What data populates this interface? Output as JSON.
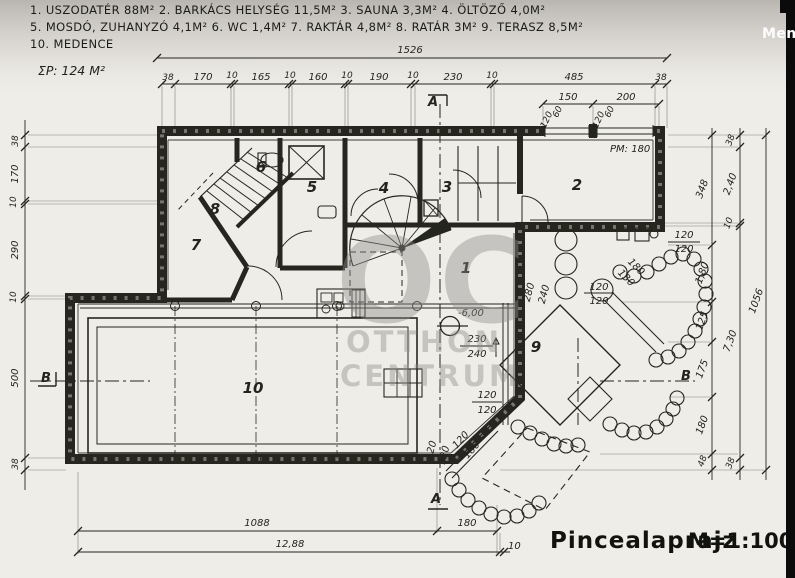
{
  "overlay": {
    "save_label": "Ment"
  },
  "legend": {
    "line1": "1. USZODATÉR 88M²   2. BARKÁCS HELYSÉG 11,5M²   3. SAUNA 3,3M²   4. ÖLTÖZŐ 4,0M²",
    "line2": "5. MOSDÓ, ZUHANYZÓ 4,1M²   6. WC 1,4M²   7. RAKTÁR 4,8M²   8. RATÁR 3M²   9. TERASZ 8,5M²",
    "line3": "10. MEDENCE"
  },
  "summary": {
    "total_area": "ΣP: 124 M²"
  },
  "title": {
    "name": "Pincealaprajz",
    "scale": "M=1:100"
  },
  "watermark": {
    "monogram": "OC",
    "line1": "OTTHON",
    "line2": "CENTRUM"
  },
  "rooms": {
    "n1": "1",
    "n2": "2",
    "n3": "3",
    "n4": "4",
    "n5": "5",
    "n6": "6",
    "n7": "7",
    "n8": "8",
    "n9": "9",
    "n10": "10"
  },
  "annotations": {
    "level": "-6,00",
    "ceiling": "PM: 180"
  },
  "sections": {
    "a": "A",
    "b": "B"
  },
  "dims": {
    "top_total": "1526",
    "top_chain": [
      "38",
      "170",
      "10",
      "165",
      "10",
      "160",
      "10",
      "190",
      "10",
      "230",
      "10",
      "485",
      "38"
    ],
    "top_sub": [
      "150",
      "200"
    ],
    "windows": [
      "120",
      "60",
      "120",
      "60"
    ],
    "left_chain": [
      "38",
      "170",
      "10",
      "290",
      "10",
      "500",
      "38"
    ],
    "right_inner": [
      "348",
      "1,80",
      "125",
      "175",
      "180",
      "48"
    ],
    "right_outer": [
      "38",
      "2,40",
      "10",
      "7,30",
      "38"
    ],
    "right_total": "1056",
    "bottom": {
      "b1": "1088",
      "b2": "12,88",
      "b3": "180",
      "b4": "10"
    },
    "terrace": {
      "nw1": "280",
      "nw2": "240",
      "w1": "230",
      "w2": "240",
      "sw1": "120",
      "sw2": "120",
      "se1": "120",
      "se2": "120",
      "ne1": "120",
      "ne2": "120",
      "e1": "120",
      "e2": "120",
      "steps_sw1": "120",
      "steps_sw2": "180",
      "steps_ne1": "180",
      "steps_ne2": "130"
    }
  }
}
